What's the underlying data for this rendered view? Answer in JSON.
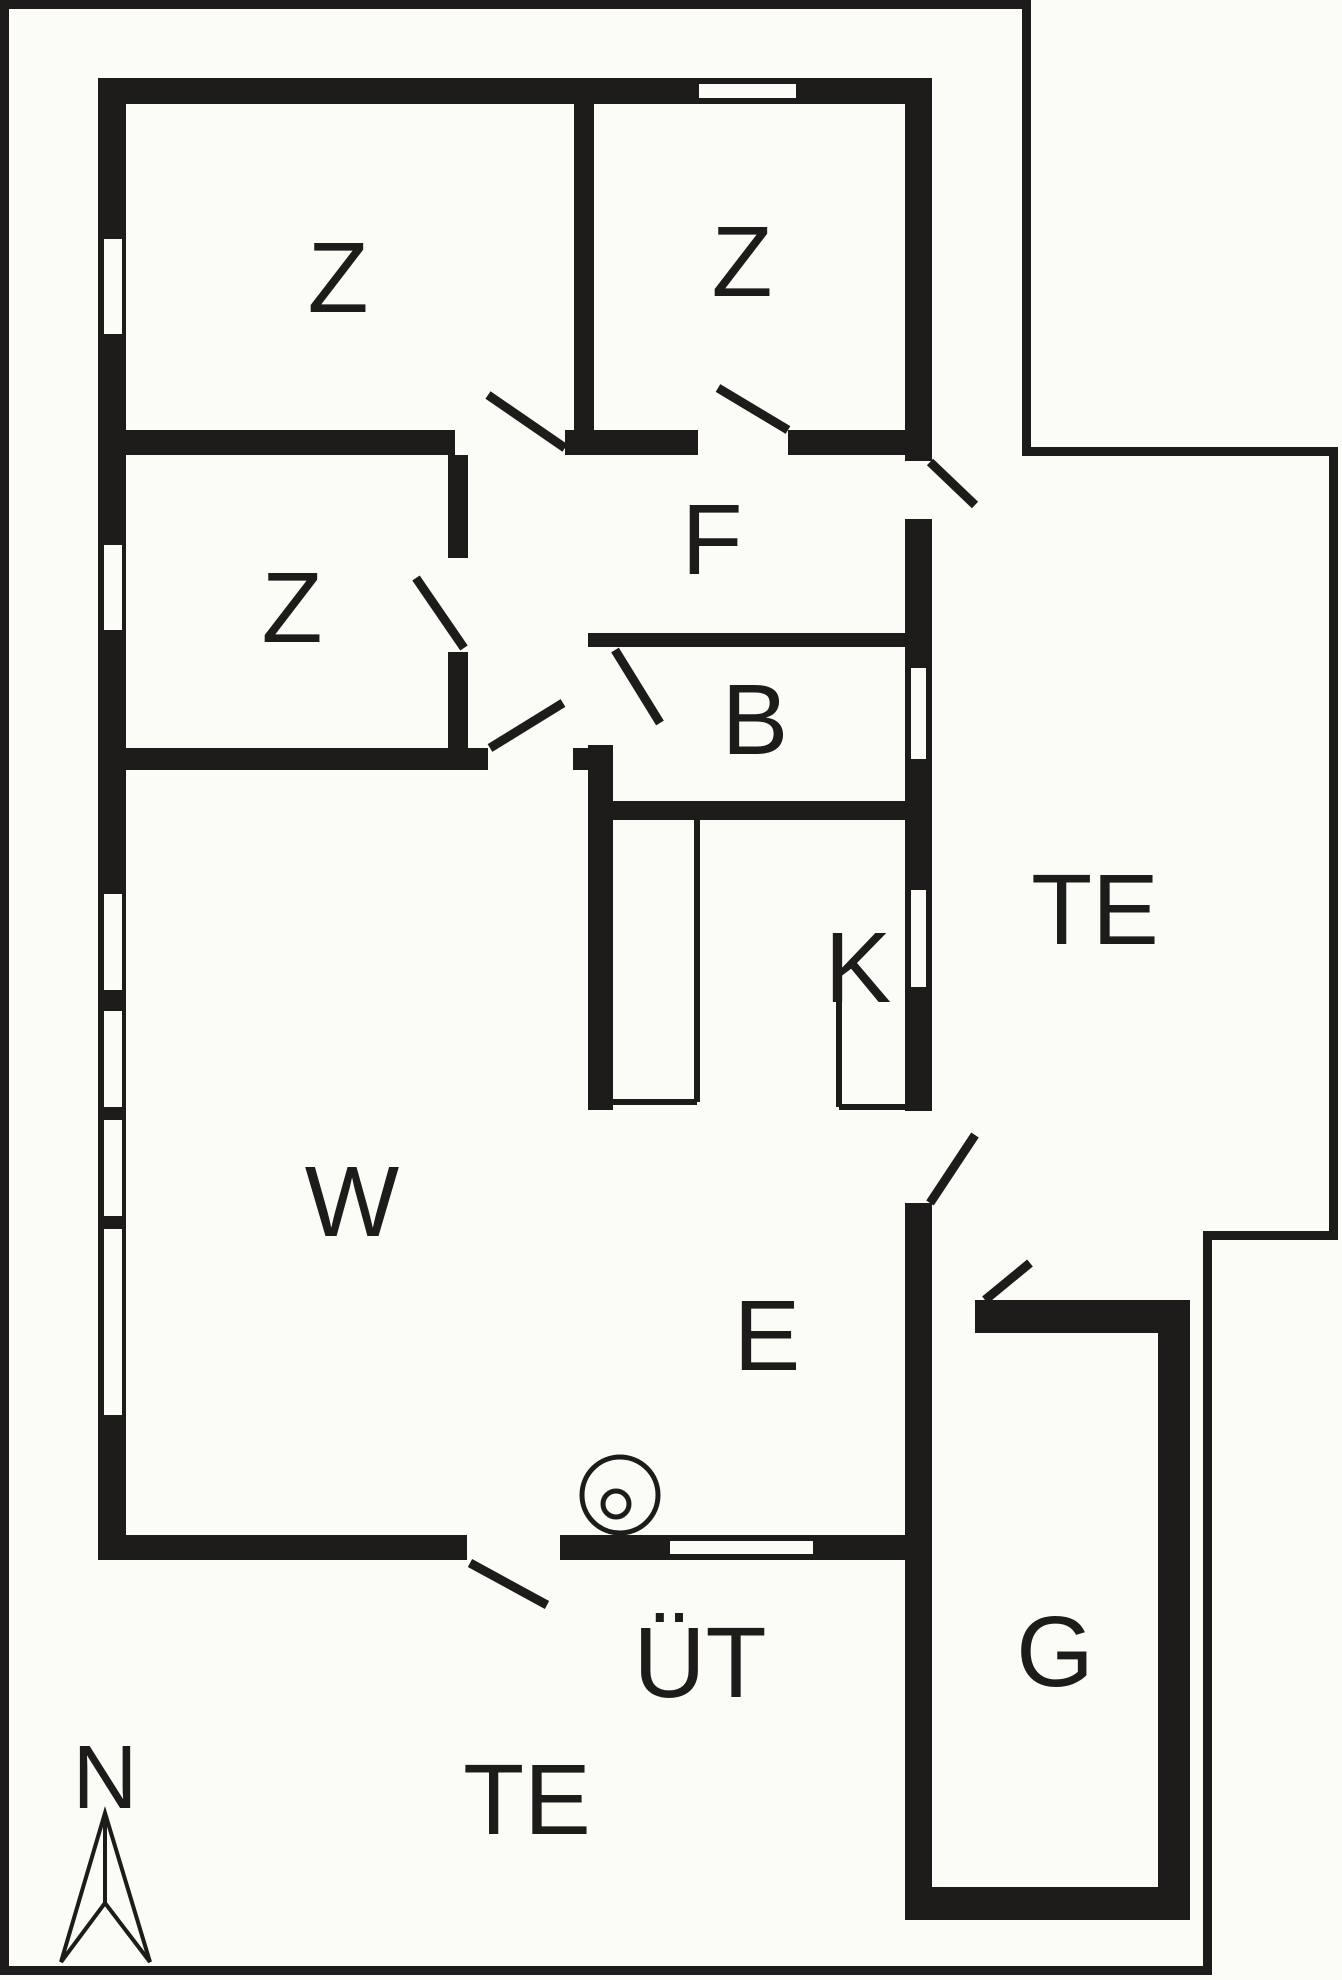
{
  "canvas": {
    "width": 1342,
    "height": 1980,
    "background": "#FCFCF7",
    "ink": "#1E1C1A"
  },
  "room_labels": [
    {
      "id": "z1",
      "text": "Z",
      "x": 338,
      "y": 278,
      "size": 100
    },
    {
      "id": "z2",
      "text": "Z",
      "x": 742,
      "y": 262,
      "size": 100
    },
    {
      "id": "z3",
      "text": "Z",
      "x": 292,
      "y": 608,
      "size": 100
    },
    {
      "id": "f",
      "text": "F",
      "x": 712,
      "y": 540,
      "size": 100
    },
    {
      "id": "b",
      "text": "B",
      "x": 755,
      "y": 720,
      "size": 100
    },
    {
      "id": "k",
      "text": "K",
      "x": 858,
      "y": 968,
      "size": 100
    },
    {
      "id": "te-east",
      "text": "TE",
      "x": 1095,
      "y": 910,
      "size": 100
    },
    {
      "id": "w",
      "text": "W",
      "x": 352,
      "y": 1202,
      "size": 100
    },
    {
      "id": "e",
      "text": "E",
      "x": 767,
      "y": 1336,
      "size": 100
    },
    {
      "id": "g",
      "text": "G",
      "x": 1055,
      "y": 1652,
      "size": 100
    },
    {
      "id": "ut",
      "text": "ÜT",
      "x": 700,
      "y": 1663,
      "size": 100
    },
    {
      "id": "te-south",
      "text": "TE",
      "x": 527,
      "y": 1800,
      "size": 100
    },
    {
      "id": "north",
      "text": "N",
      "x": 105,
      "y": 1778,
      "size": 90
    }
  ],
  "plot_boundary": [
    {
      "name": "plot-border-left",
      "x": 0,
      "y": 0,
      "w": 9,
      "h": 1975
    },
    {
      "name": "plot-border-top",
      "x": 0,
      "y": 0,
      "w": 1031,
      "h": 9
    },
    {
      "name": "plot-border-notch-vertical",
      "x": 1022,
      "y": 0,
      "w": 9,
      "h": 456
    },
    {
      "name": "plot-border-notch-horizontal",
      "x": 1022,
      "y": 447,
      "w": 316,
      "h": 9
    },
    {
      "name": "plot-border-right",
      "x": 1329,
      "y": 447,
      "w": 9,
      "h": 793
    },
    {
      "name": "plot-border-step-horizontal",
      "x": 1203,
      "y": 1231,
      "w": 135,
      "h": 9
    },
    {
      "name": "plot-border-step-vertical",
      "x": 1203,
      "y": 1231,
      "w": 9,
      "h": 744
    },
    {
      "name": "plot-border-bottom",
      "x": 0,
      "y": 1966,
      "w": 1212,
      "h": 9
    }
  ],
  "walls": [
    {
      "name": "wall-north",
      "x": 98,
      "y": 78,
      "w": 834,
      "h": 26
    },
    {
      "name": "wall-west",
      "x": 98,
      "y": 78,
      "w": 28,
      "h": 1482
    },
    {
      "name": "wall-east-upper",
      "x": 905,
      "y": 78,
      "w": 27,
      "h": 383
    },
    {
      "name": "wall-east-middle",
      "x": 905,
      "y": 519,
      "w": 27,
      "h": 592
    },
    {
      "name": "wall-east-lower",
      "x": 905,
      "y": 1203,
      "w": 27,
      "h": 717
    },
    {
      "name": "wall-south-west",
      "x": 98,
      "y": 1535,
      "w": 369,
      "h": 25
    },
    {
      "name": "wall-south-east",
      "x": 560,
      "y": 1535,
      "w": 372,
      "h": 25
    },
    {
      "name": "wall-bedroom-band-a",
      "x": 126,
      "y": 430,
      "w": 329,
      "h": 25
    },
    {
      "name": "wall-bedroom-band-b",
      "x": 565,
      "y": 430,
      "w": 133,
      "h": 25
    },
    {
      "name": "wall-bedroom-band-c",
      "x": 788,
      "y": 430,
      "w": 117,
      "h": 25
    },
    {
      "name": "wall-z1-z2-divider",
      "x": 574,
      "y": 104,
      "w": 20,
      "h": 326
    },
    {
      "name": "wall-z3-east-upper",
      "x": 448,
      "y": 455,
      "w": 20,
      "h": 103
    },
    {
      "name": "wall-z3-east-lower",
      "x": 448,
      "y": 652,
      "w": 20,
      "h": 118
    },
    {
      "name": "wall-living-top-a",
      "x": 126,
      "y": 748,
      "w": 362,
      "h": 22
    },
    {
      "name": "wall-living-top-b",
      "x": 573,
      "y": 748,
      "w": 40,
      "h": 22
    },
    {
      "name": "wall-kitchen-west",
      "x": 588,
      "y": 745,
      "w": 25,
      "h": 365
    },
    {
      "name": "wall-bath-top",
      "x": 588,
      "y": 633,
      "w": 317,
      "h": 14
    },
    {
      "name": "wall-bath-bottom",
      "x": 588,
      "y": 801,
      "w": 317,
      "h": 19
    },
    {
      "name": "garage-wall-north",
      "x": 975,
      "y": 1300,
      "w": 215,
      "h": 33
    },
    {
      "name": "garage-wall-east",
      "x": 1158,
      "y": 1300,
      "w": 32,
      "h": 620
    },
    {
      "name": "garage-wall-south",
      "x": 905,
      "y": 1887,
      "w": 285,
      "h": 33
    }
  ],
  "windows": [
    {
      "name": "window-north-z2",
      "x": 699,
      "y": 84,
      "w": 97,
      "h": 14
    },
    {
      "name": "window-west-z1",
      "x": 104,
      "y": 239,
      "w": 18,
      "h": 95
    },
    {
      "name": "window-west-z3",
      "x": 104,
      "y": 545,
      "w": 18,
      "h": 85
    },
    {
      "name": "window-west-w1",
      "x": 104,
      "y": 894,
      "w": 18,
      "h": 96
    },
    {
      "name": "window-west-w2",
      "x": 104,
      "y": 1011,
      "w": 18,
      "h": 96
    },
    {
      "name": "window-west-w3",
      "x": 104,
      "y": 1120,
      "w": 18,
      "h": 96
    },
    {
      "name": "window-west-w4",
      "x": 104,
      "y": 1229,
      "w": 18,
      "h": 186
    },
    {
      "name": "window-east-b",
      "x": 911,
      "y": 668,
      "w": 15,
      "h": 91
    },
    {
      "name": "window-east-k",
      "x": 911,
      "y": 890,
      "w": 15,
      "h": 97
    },
    {
      "name": "window-south",
      "x": 670,
      "y": 1541,
      "w": 143,
      "h": 13
    }
  ],
  "door_leaves": [
    {
      "name": "door-leaf-z1",
      "x1": 565,
      "y1": 448,
      "x2": 488,
      "y2": 395
    },
    {
      "name": "door-leaf-z2",
      "x1": 788,
      "y1": 430,
      "x2": 718,
      "y2": 388
    },
    {
      "name": "door-leaf-z3",
      "x1": 464,
      "y1": 648,
      "x2": 416,
      "y2": 578
    },
    {
      "name": "door-leaf-bath",
      "x1": 615,
      "y1": 650,
      "x2": 660,
      "y2": 723
    },
    {
      "name": "door-leaf-hall-living",
      "x1": 490,
      "y1": 748,
      "x2": 563,
      "y2": 703
    },
    {
      "name": "door-leaf-hall-terrace",
      "x1": 930,
      "y1": 462,
      "x2": 975,
      "y2": 505
    },
    {
      "name": "door-leaf-dining-terrace",
      "x1": 930,
      "y1": 1203,
      "x2": 975,
      "y2": 1135
    },
    {
      "name": "door-leaf-garage",
      "x1": 985,
      "y1": 1300,
      "x2": 1030,
      "y2": 1263
    },
    {
      "name": "door-leaf-covered-terrace",
      "x1": 470,
      "y1": 1563,
      "x2": 547,
      "y2": 1605
    }
  ],
  "fixtures": {
    "counter_lines": [
      {
        "name": "kitchen-counter-left-vertical",
        "x1": 697,
        "y1": 820,
        "x2": 697,
        "y2": 1102
      },
      {
        "name": "kitchen-counter-left-bottom",
        "x1": 613,
        "y1": 1102,
        "x2": 697,
        "y2": 1102
      },
      {
        "name": "kitchen-counter-right-vertical",
        "x1": 839,
        "y1": 990,
        "x2": 839,
        "y2": 1107
      },
      {
        "name": "kitchen-counter-right-bottom",
        "x1": 839,
        "y1": 1107,
        "x2": 905,
        "y2": 1107
      }
    ],
    "stove_circles": [
      {
        "name": "stove-outer-circle",
        "cx": 620,
        "cy": 1495,
        "r": 38
      },
      {
        "name": "stove-inner-circle",
        "cx": 616,
        "cy": 1504,
        "r": 13
      }
    ]
  },
  "north_arrow": {
    "outline": [
      [
        105,
        1813
      ],
      [
        150,
        1962
      ],
      [
        105,
        1903
      ],
      [
        61,
        1962
      ]
    ],
    "center_line": {
      "x1": 105,
      "y1": 1813,
      "x2": 105,
      "y2": 1903
    }
  }
}
